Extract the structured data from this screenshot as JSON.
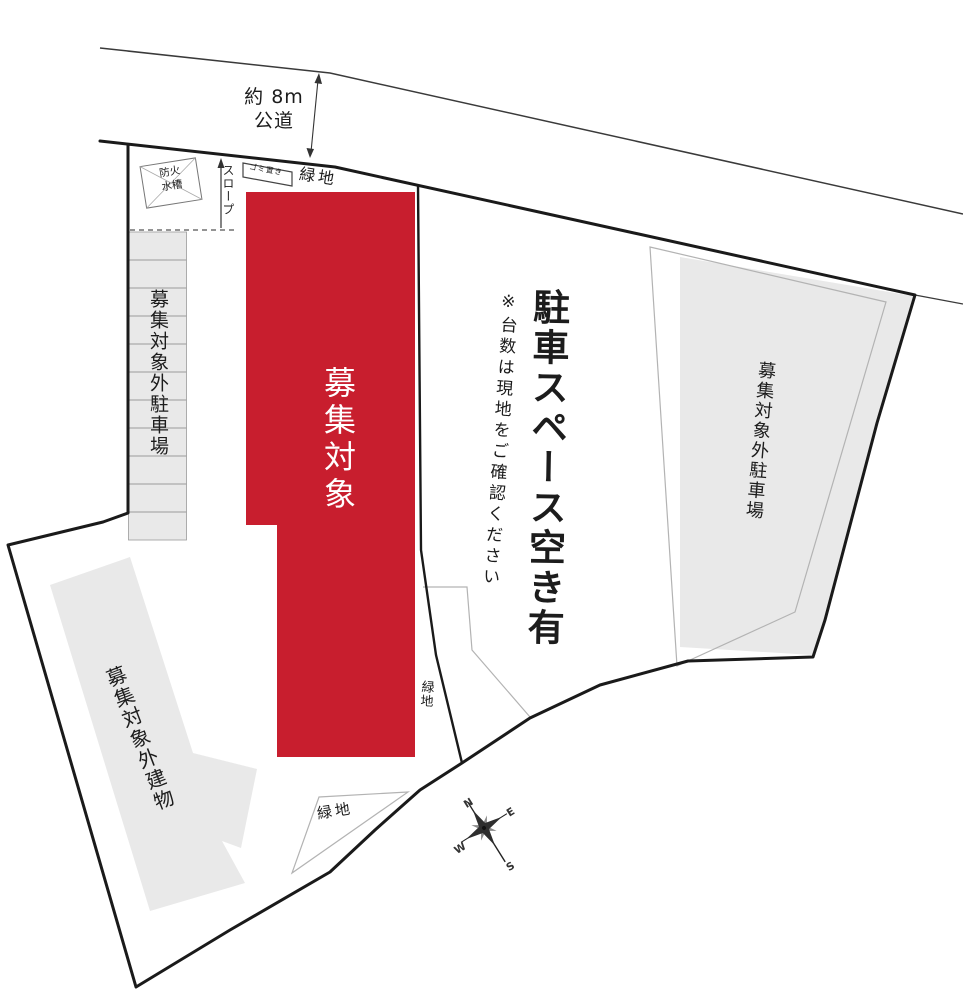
{
  "plan": {
    "road": {
      "line1": "約 8m",
      "line2": "公道"
    },
    "labels": {
      "green_top": "緑地",
      "green_mid": "緑地",
      "green_bottom": "緑地",
      "slope": "スロープ",
      "fire_tank_line1": "防火",
      "fire_tank_line2": "水槽",
      "garbage": "ゴミ置き",
      "left_parking": "募集対象外駐車場",
      "right_parking": "募集対象外駐車場",
      "building": "募集対象外建物",
      "target": "募集対象",
      "notice_main": "駐車スペース空き有",
      "notice_sub": "※台数は現地をご確認ください"
    },
    "compass": {
      "n": "N",
      "e": "E",
      "s": "S",
      "w": "W"
    },
    "colors": {
      "target_red": "#c81e2e",
      "area_gray": "#e9e9e9",
      "boundary_dark": "#1a1a1a",
      "thin_outline": "#b3b3b3"
    }
  }
}
